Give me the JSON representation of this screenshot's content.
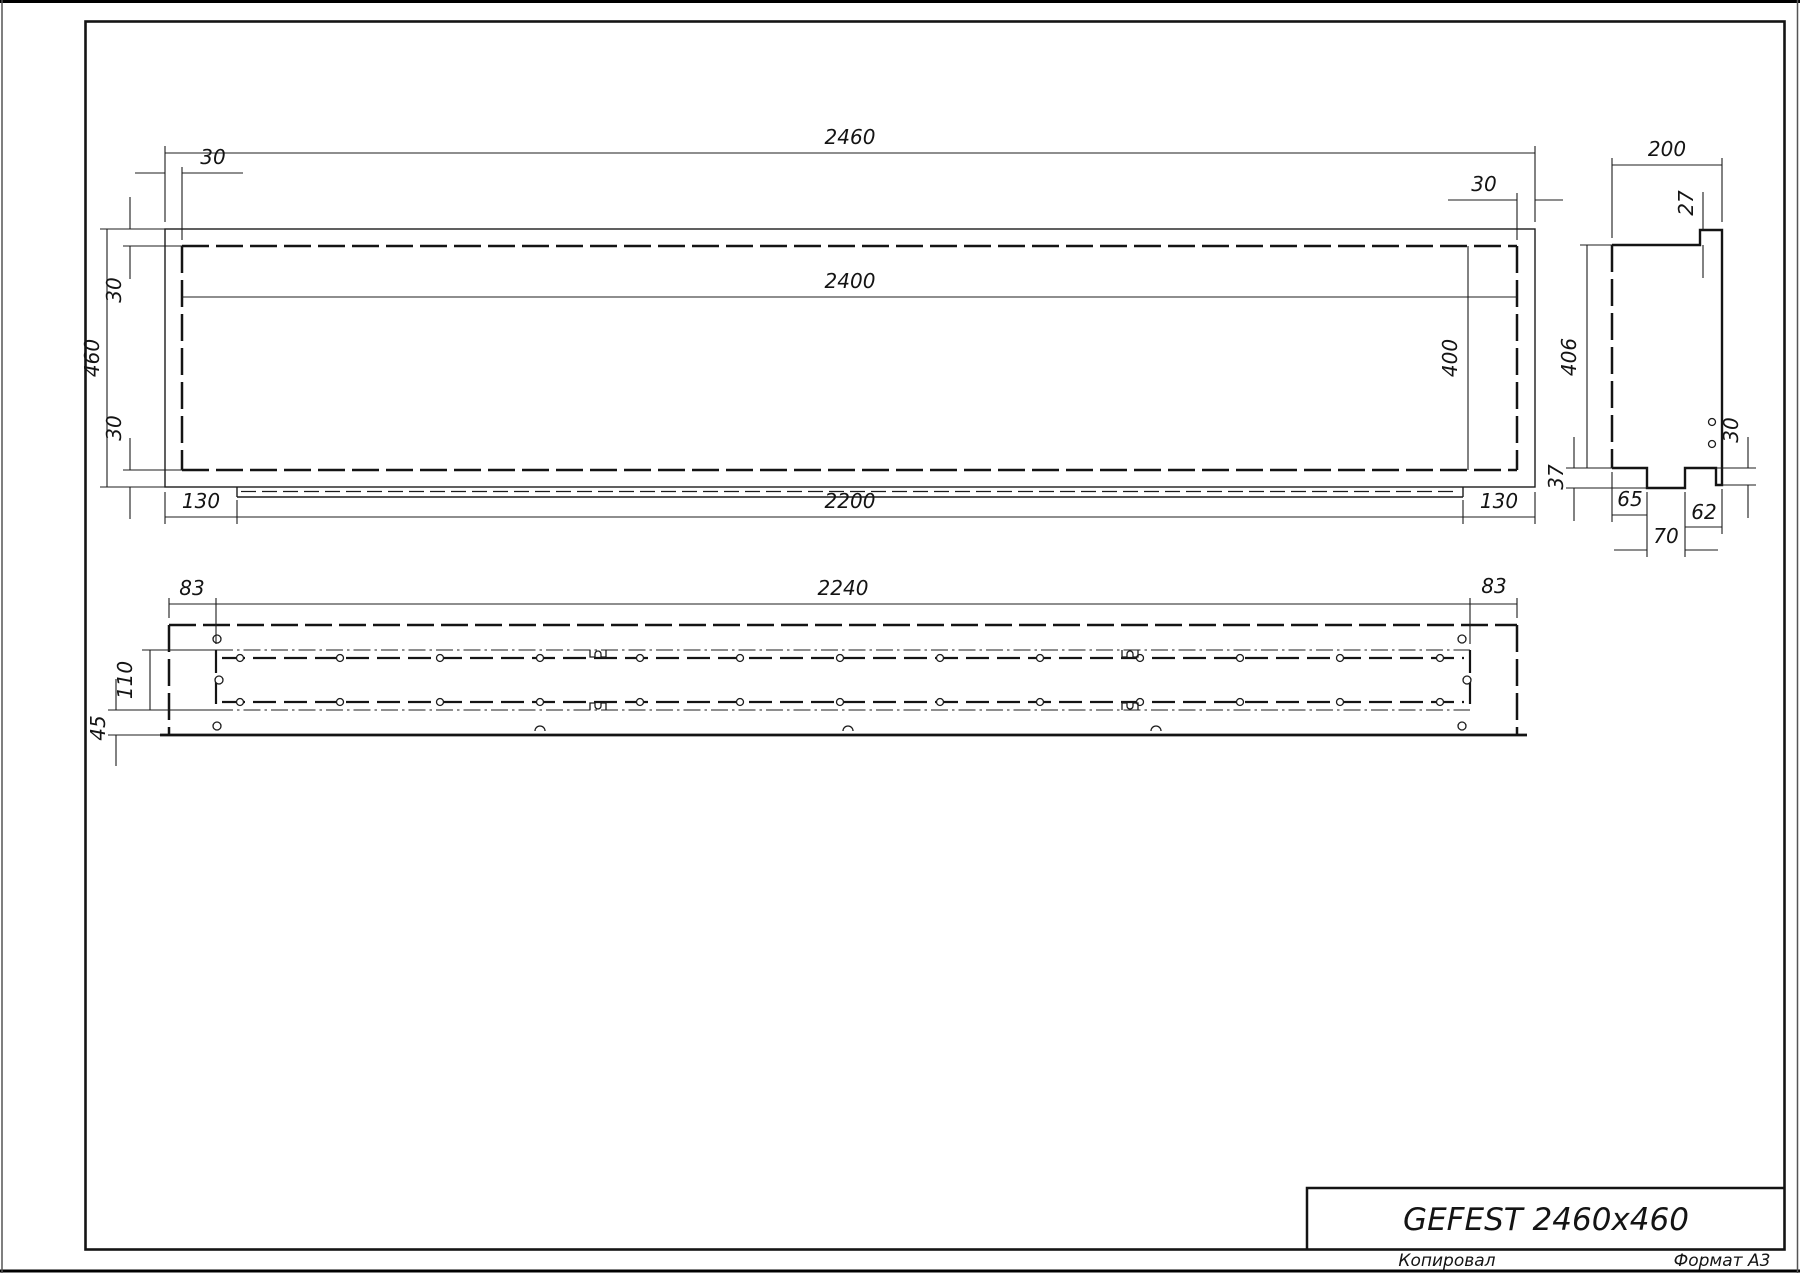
{
  "title_block": {
    "model": "GEFEST 2460x460"
  },
  "footer": {
    "copied_label": "Копировал",
    "format_label": "Формат А3"
  },
  "front_view": {
    "total_width": "2460",
    "border_top_left": "30",
    "border_top_right": "30",
    "opening_width": "2400",
    "total_height": "460",
    "border_left_top": "30",
    "border_left_bottom": "30",
    "opening_height": "400",
    "bottom_inset_left": "130",
    "bottom_width": "2200",
    "bottom_inset_right": "130"
  },
  "side_view": {
    "depth": "200",
    "top_lip": "27",
    "height": "406",
    "hole_offset": "30",
    "bracket_depth": "37",
    "foot_offset": "65",
    "foot_to_edge": "62",
    "foot_width": "70"
  },
  "plan_view": {
    "side_margin_left": "83",
    "opening_width": "2240",
    "side_margin_right": "83",
    "channel_width": "110",
    "flange_depth": "45"
  }
}
